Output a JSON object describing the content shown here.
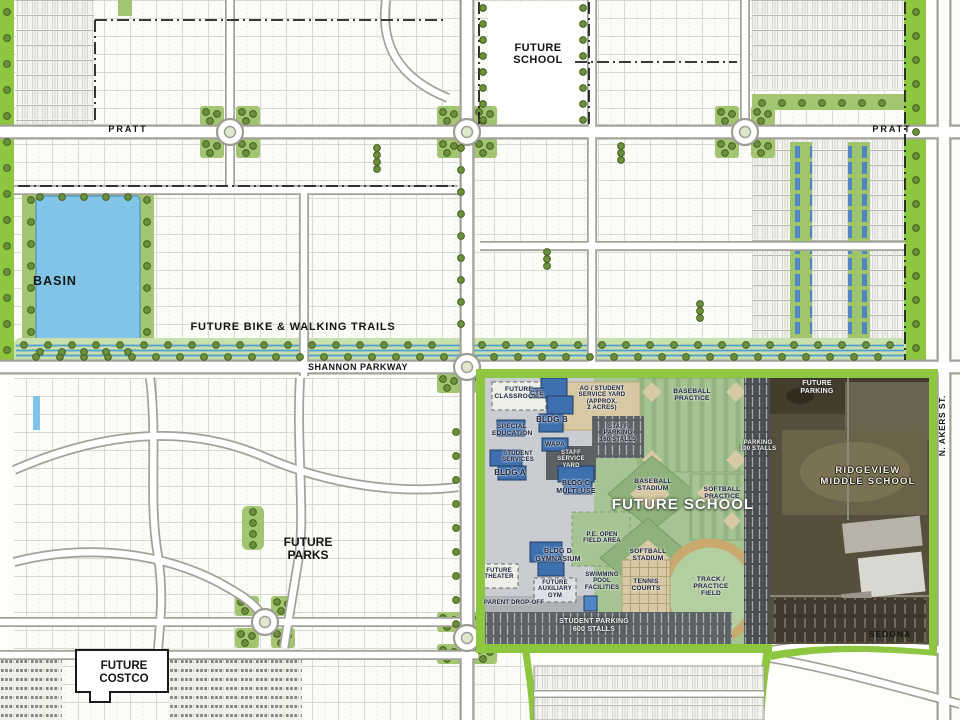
{
  "map_labels": {
    "future_school_parcel": "FUTURE\nSCHOOL",
    "pratt_west": "PRATT",
    "pratt_east": "PRATT",
    "basin": "BASIN",
    "bike_trails": "FUTURE BIKE & WALKING TRAILS",
    "shannon_parkway": "SHANNON PARKWAY",
    "future_parks": "FUTURE\nPARKS",
    "future_costco": "FUTURE\nCOSTCO",
    "n_akers_st": "N. AKERS ST.",
    "sedona": "SEDONA"
  },
  "school_site": {
    "headline": "FUTURE SCHOOL",
    "future_classrooms": "FUTURE\nCLASSROOMS",
    "cte": "CTE",
    "bldg_b": "BLDG B",
    "ag_service_yard": "AG / STUDENT\nSERVICE YARD\n(APPROX.\n2 ACRES)",
    "special_education": "SPECIAL\nEDUCATION",
    "bldg_misc": "WAPA",
    "staff_parking": "STAFF\nPARKING\n160 STALLS",
    "staff_service_yard": "STAFF\nSERVICE\nYARD",
    "student_services": "STUDENT\nSERVICES",
    "bldg_a": "BLDG A",
    "bldg_c": "BLDG C\nMULTI-USE",
    "baseball_practice": "BASEBALL\nPRACTICE",
    "baseball_stadium": "BASEBALL\nSTADIUM",
    "softball_practice": "SOFTBALL\nPRACTICE",
    "pe_open_field": "P.E. OPEN\nFIELD AREA",
    "softball_stadium": "SOFTBALL\nSTADIUM",
    "bldg_d": "BLDG D\nGYMNASIUM",
    "future_theater": "FUTURE\nTHEATER",
    "future_auxiliary_gym": "FUTURE\nAUXILIARY\nGYM",
    "swimming_pool": "SWIMMING\nPOOL\nFACILITIES",
    "tennis_courts": "TENNIS\nCOURTS",
    "track_practice_field": "TRACK /\nPRACTICE\nFIELD",
    "parent_drop_off": "PARENT DROP-OFF",
    "student_parking": "STUDENT PARKING\n600 STALLS",
    "parking_100": "PARKING\n100 STALLS"
  },
  "aerial": {
    "ridgeview_middle_school": "RIDGEVIEW\nMIDDLE SCHOOL",
    "future_parking": "FUTURE\nPARKING"
  },
  "colors": {
    "border_green": "#8dc63f",
    "tree_green": "#6b8f3c",
    "basin_blue": "#82c4e8",
    "trail_blue": "#4f9fd0",
    "building_blue": "#3e6fae",
    "field_green": "#a6c493",
    "plan_gray": "#c9cdd2",
    "parking_dark": "#5c6165",
    "aerial_brown": "#574f3d"
  }
}
